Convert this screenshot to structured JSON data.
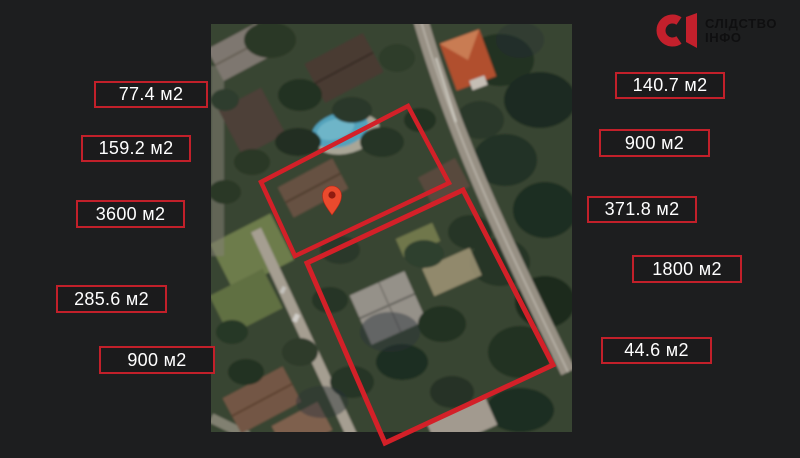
{
  "logo": {
    "mark": "СІ",
    "line1": "СЛІДСТВО",
    "line2": "ІНФО"
  },
  "areas": {
    "left": [
      "77.4 м2",
      "159.2 м2",
      "3600 м2",
      "285.6 м2",
      "900 м2"
    ],
    "right": [
      "140.7 м2",
      "900 м2",
      "371.8 м2",
      "1800 м2",
      "44.6 м2"
    ]
  },
  "map": {
    "marker_icon": "map-pin-icon",
    "parcel_outlines_count": 2
  },
  "colors": {
    "background": "#1d1e1f",
    "accent_red": "#d32028",
    "label_border": "#c2202a",
    "label_text": "#ffffff",
    "pin_fill": "#ea4a2d",
    "logo_red": "#c3202c",
    "logo_text": "#0f0f10"
  }
}
